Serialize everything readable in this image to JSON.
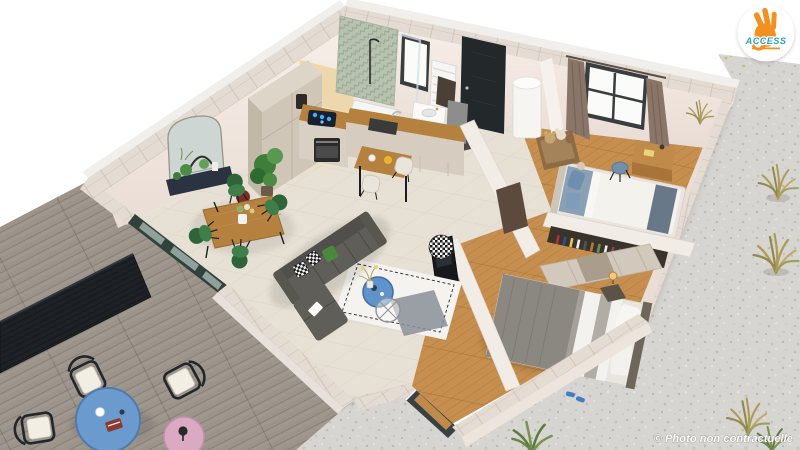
{
  "meta": {
    "description": "3D isometric cutaway rendering of an apartment floor plan with terrace",
    "background": "#ffffff"
  },
  "branding": {
    "logo_text": "ACCESS",
    "logo_icon": "ok-hand-icon",
    "colors": {
      "hand": "#f39120",
      "text": "#27a4b6",
      "badge": "#ffffff"
    }
  },
  "watermark": {
    "text": "© Photo non contractuelle",
    "color": "#ffffff"
  },
  "scene": {
    "view": "isometric-cutaway",
    "rooms": [
      {
        "name": "terrace",
        "floor": "wood-deck",
        "furniture": [
          "black-slat-railing",
          "wire-lounge-chair",
          "wire-lounge-chair",
          "wire-lounge-chair",
          "round-table-blue",
          "side-table-pink"
        ]
      },
      {
        "name": "living-room",
        "floor": "tile",
        "furniture": [
          "corner-sofa-gray",
          "white-rug",
          "coffee-table-blue",
          "wire-side-table",
          "pouf-houndstooth",
          "tv-panel",
          "gray-floor-mat"
        ]
      },
      {
        "name": "dining-area",
        "floor": "tile",
        "furniture": [
          "wood-dining-table",
          "green-chair",
          "green-chair",
          "green-chair",
          "green-chair",
          "arched-mirror",
          "plant-ledge",
          "potted-plant"
        ]
      },
      {
        "name": "kitchen",
        "floor": "tile",
        "furniture": [
          "tall-cabinets",
          "induction-cooktop",
          "oven",
          "sink-counter",
          "bar-table",
          "stool",
          "stool",
          "coffee-machine",
          "potted-plant"
        ]
      },
      {
        "name": "bathroom",
        "floor": "tile",
        "furniture": [
          "green-chevron-shower-wall",
          "shower-tray",
          "glass-panel",
          "vanity-sink",
          "towel-radiator",
          "window"
        ]
      },
      {
        "name": "entry",
        "floor": "tile",
        "furniture": [
          "front-door-black",
          "doormat",
          "water-heater",
          "storage-cabinet"
        ]
      },
      {
        "name": "children-bedroom",
        "floor": "wood",
        "furniture": [
          "single-bed",
          "teddy-bench",
          "desk",
          "desk-chair",
          "window-with-curtains",
          "hallway-door"
        ]
      },
      {
        "name": "master-bedroom",
        "floor": "wood",
        "furniture": [
          "double-bed",
          "wardrobe",
          "bookshelf-wall",
          "nightstand-lamp",
          "blue-slippers",
          "front-window"
        ]
      },
      {
        "name": "gravel-yard",
        "floor": "gravel",
        "furniture": [
          "ornamental-grass",
          "ornamental-grass",
          "ornamental-grass",
          "ornamental-grass",
          "green-shrub"
        ]
      }
    ],
    "palette": {
      "wall": "#f5ece6",
      "wall_top_stone": "#e4dbd3",
      "tile_floor": "#e7e1d5",
      "wood_floor": "#c68f4f",
      "deck": "#9c938b",
      "gravel": "#d7d5d1",
      "sofa": "#5f5e59",
      "chair_green": "#3f7d49",
      "table_wood": "#b5813f",
      "accent_blue": "#5e93cc",
      "accent_pink": "#d9aac2",
      "railing": "#1e2125",
      "door_dark": "#23282b",
      "shower_tile": "#b7c3b0"
    }
  }
}
